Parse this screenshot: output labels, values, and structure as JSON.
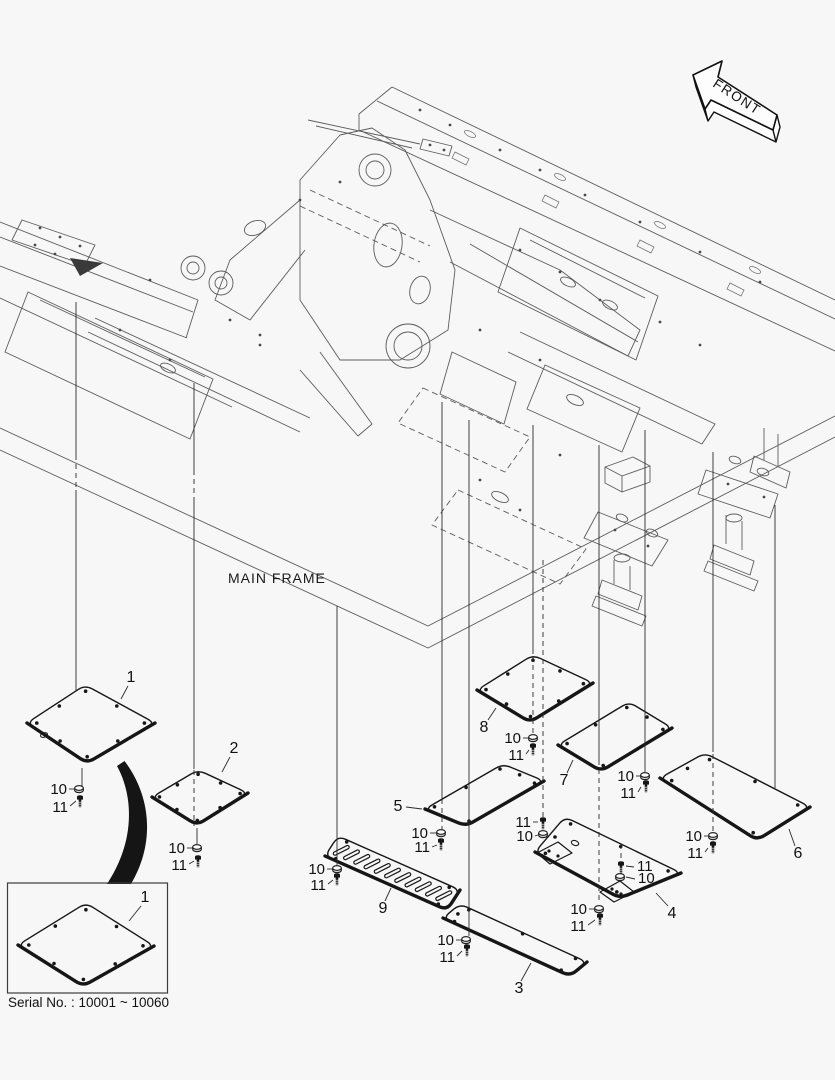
{
  "diagram": {
    "front_label": "FRONT",
    "frame_label": "MAIN FRAME",
    "serial_note": "Serial No. : 10001 ~ 10060",
    "inset_part_number": "1",
    "hardware": {
      "washer_label": "10",
      "bolt_label": "11"
    },
    "part_numbers": [
      "1",
      "2",
      "3",
      "4",
      "5",
      "6",
      "7",
      "8",
      "9"
    ],
    "colors": {
      "background": "#f7f7f8",
      "frame_line": "#5c5c5c",
      "part_line": "#161616",
      "text": "#111111"
    }
  }
}
